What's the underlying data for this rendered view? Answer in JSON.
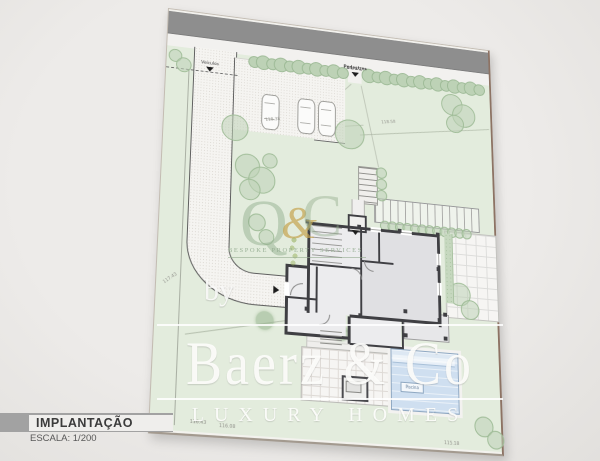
{
  "title_block": {
    "title": "IMPLANTAÇÃO",
    "scale": "ESCALA: 1/200"
  },
  "watermark": {
    "by": "by",
    "brand": "Baerz & Co",
    "brand_sub": "LUXURY HOMES",
    "monogram": {
      "q": "Q",
      "amp": "&",
      "c": "C"
    },
    "monogram_tagline": "BESPOKE PROPERTY SERVICES"
  },
  "sheet": {
    "entrance_vehicles_label": "Veículos",
    "entrance_pedestrians_label": "Pedestres",
    "pool_label": "Piscina",
    "elevations": {
      "left_boundary": "117.43",
      "parking": "118.38",
      "upper_lawn": "118.58",
      "bottom_left_a": "116.43",
      "bottom_left_b": "116.08",
      "bottom_right": "115.18"
    }
  },
  "colors": {
    "page_background": "#eae8e6",
    "sheet_paper": "#f8f7f4",
    "road": "#8e8e8e",
    "lawn": "#e3ecdd",
    "hedge": "#bdd2b6",
    "wall": "#3f3f43",
    "pool_water": "#cfdff0",
    "watermark_white": "#ffffff",
    "monogram_green": "#94af8f",
    "monogram_gold": "#c4a44e",
    "title_bar_gray": "#a2a2a2"
  }
}
